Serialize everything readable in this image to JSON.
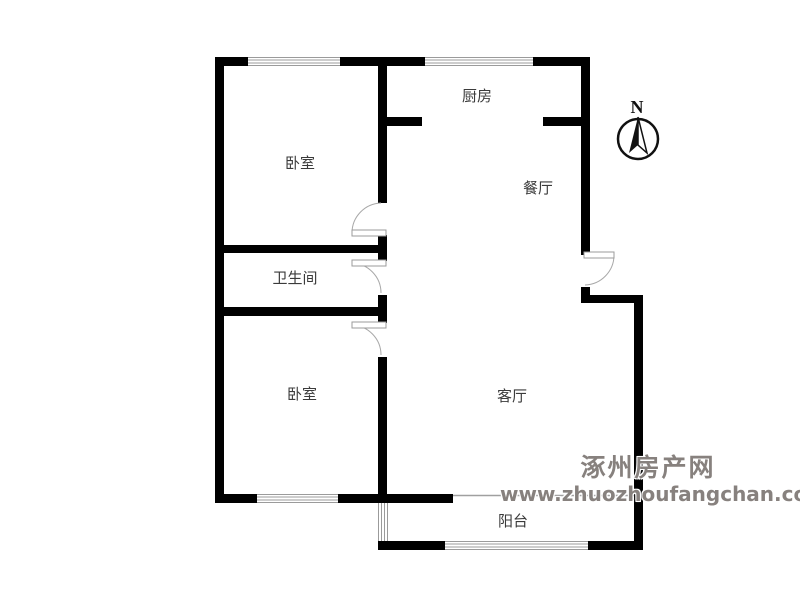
{
  "floorplan": {
    "rooms": [
      {
        "id": "bedroom-top",
        "label": "卧室"
      },
      {
        "id": "kitchen",
        "label": "厨房"
      },
      {
        "id": "dining",
        "label": "餐厅"
      },
      {
        "id": "bathroom",
        "label": "卫生间"
      },
      {
        "id": "bedroom-bottom",
        "label": "卧室"
      },
      {
        "id": "living",
        "label": "客厅"
      },
      {
        "id": "balcony",
        "label": "阳台"
      }
    ],
    "compass": {
      "label": "N"
    },
    "colors": {
      "wall": "#000000",
      "window_line": "#9b9b9b",
      "door_line": "#a8a8a8",
      "room_label": "#3b3b3b",
      "watermark": "#87817e"
    }
  },
  "watermark": {
    "line1": "涿州房产网",
    "line2": "www.zhuozhoufangchan.com"
  }
}
